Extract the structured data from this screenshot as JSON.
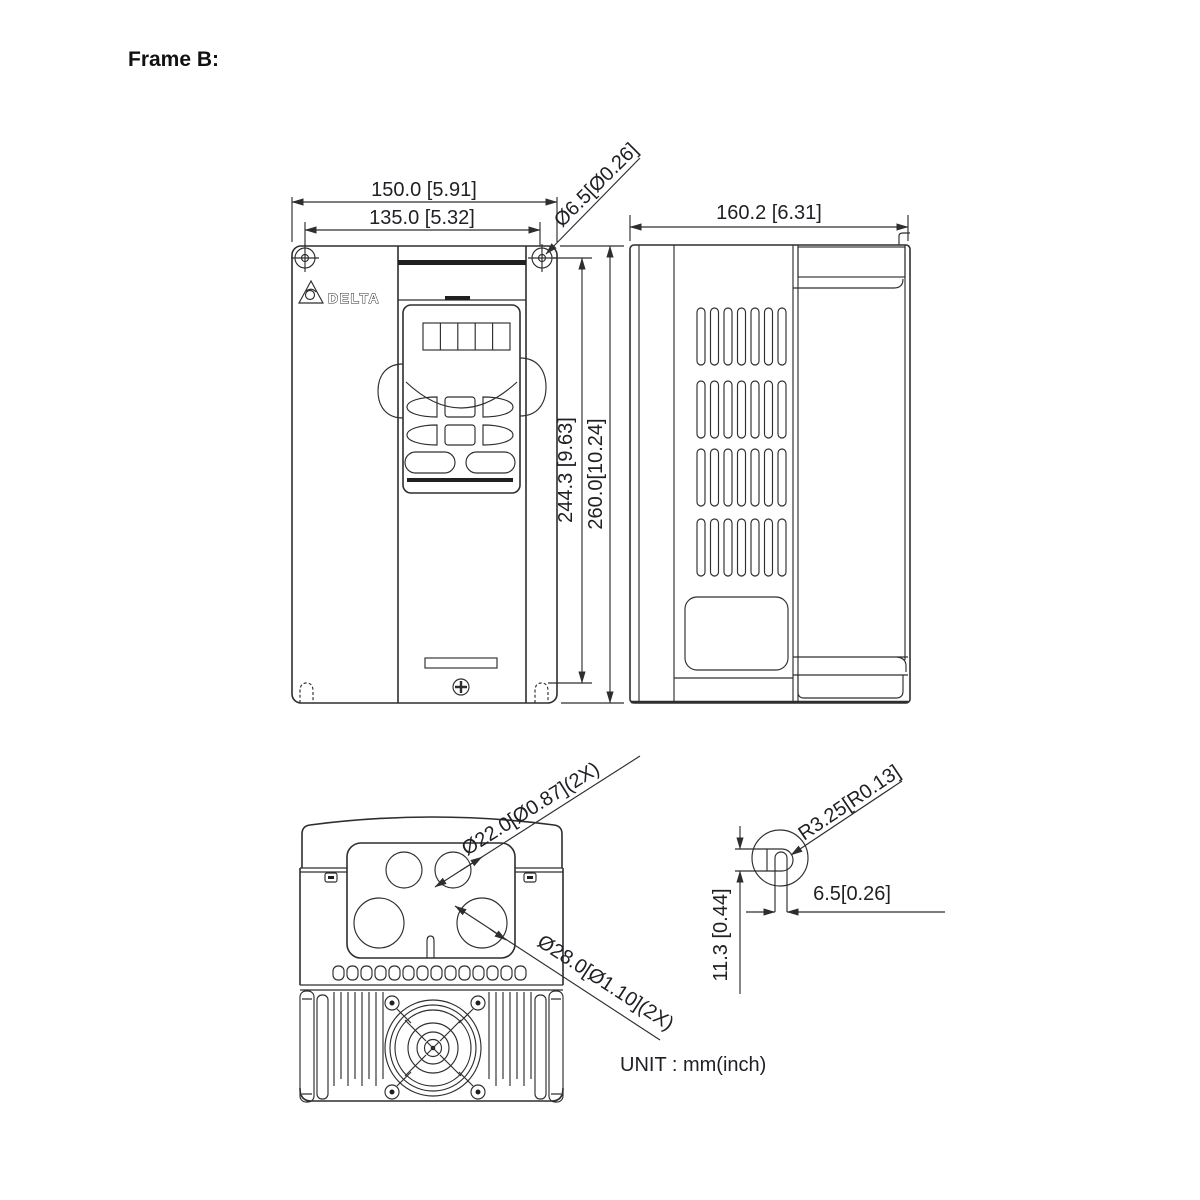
{
  "title": "Frame B:",
  "unit_note": "UNIT : mm(inch)",
  "colors": {
    "line": "#2e2e30",
    "text": "#1f1f24",
    "background": "#ffffff"
  },
  "front_view": {
    "logo_text": "DELTA",
    "dims": {
      "width_overall": "150.0 [5.91]",
      "width_mounting_holes": "135.0 [5.32]",
      "mounting_hole_diameter": "Ø6.5[Ø0.26]",
      "height_mounting_holes": "244.3 [9.63]",
      "height_overall": "260.0[10.24]"
    }
  },
  "side_view": {
    "dims": {
      "depth_overall": "160.2 [6.31]"
    }
  },
  "bottom_view": {
    "dims": {
      "conduit_hole_small": "Ø22.0[Ø0.87](2X)",
      "conduit_hole_large": "Ø28.0[Ø1.10](2X)"
    }
  },
  "detail_view": {
    "dims": {
      "slot_radius": "R3.25[R0.13]",
      "slot_width": "6.5[0.26]",
      "slot_depth": "11.3 [0.44]"
    }
  }
}
